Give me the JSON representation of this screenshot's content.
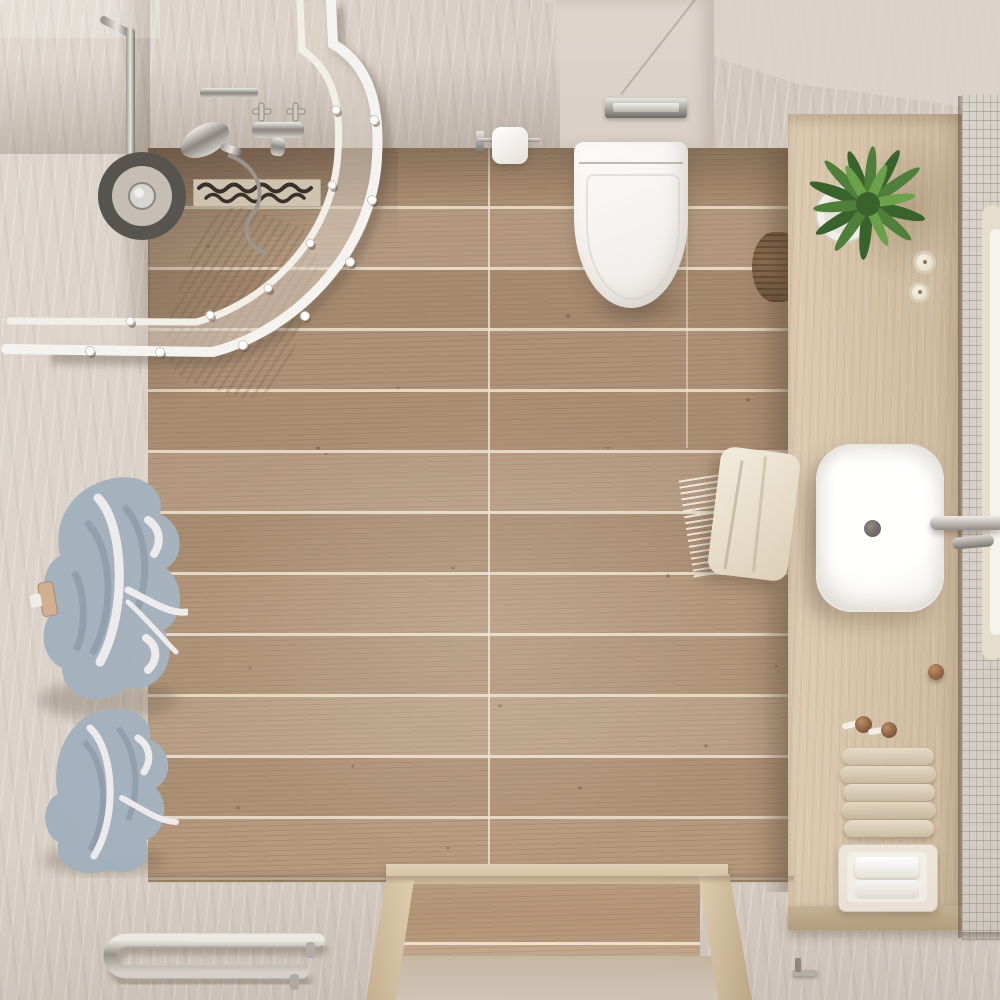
{
  "scene": {
    "title": "Top-down 3D render of a modern bathroom",
    "room": "bathroom",
    "view": "overhead",
    "objects": [
      "corner shower with curved glass enclosure",
      "rain shower head and chrome mixer valve",
      "linear drain with wave mosaic strip",
      "wall-hung white toilet with chrome flush plate",
      "toilet paper holder",
      "wood plank tile floor",
      "marble tile floor and walls",
      "wooden vanity counter",
      "green fern plant in white pot",
      "two cream candles",
      "white vessel sink with wall-mounted chrome faucet",
      "white mosaic tile wall",
      "round mirror edge",
      "rolled beige towels on shelf",
      "white towel tray",
      "cream hand towel with fringe",
      "two blue-grey bathrobes on hooks",
      "chrome towel radiator",
      "wooden doorway threshold",
      "wicker basket"
    ]
  },
  "palette": {
    "marble_base": "#d2c8bf",
    "marble_hi": "#e0d8cf",
    "marble_lo": "#bfb2a6",
    "ceiling": "#dbd3cb",
    "wall_light": "#ded5cc",
    "wood_mid": "#ad9074",
    "wood_hi": "#c9b193",
    "wood_lo": "#8c7156",
    "frame_white": "#f5f3ef",
    "glass_tint": "#ded3c4",
    "vanity_hi": "#dccab1",
    "vanity_mid": "#d2bfa3",
    "vanity_lo": "#bfa98a",
    "mosaic": "#d8d2cb",
    "fixture_white": "#f8f7f5",
    "chrome_hi": "#e9e6e1",
    "chrome_mid": "#a49f99",
    "chrome_lo": "#6e6a65",
    "robe": "#a1afbc",
    "robe_lo": "#7e8d9c",
    "robe_trim": "#eceaeb",
    "towel_beige": "#dbceb8",
    "plant_hi": "#6ca14b",
    "plant_mid": "#4f7f3a",
    "plant_lo": "#39632c",
    "bronze": "#8a5c3c",
    "drain_dark": "#37302a"
  }
}
